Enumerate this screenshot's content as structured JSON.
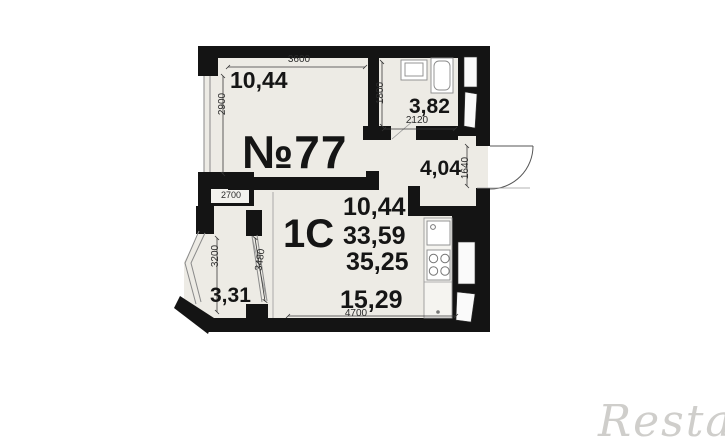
{
  "plan": {
    "apartment_number": "№77",
    "apartment_type": "1C",
    "rooms": {
      "bedroom_area": "10,44",
      "bathroom_area": "3,82",
      "hallway_area": "4,04",
      "living_area": "15,29",
      "balcony_area": "3,31"
    },
    "area_summary": [
      "10,44",
      "33,59",
      "35,25"
    ],
    "dimensions": {
      "bedroom_width": "3600",
      "bedroom_depth": "2900",
      "bathroom_depth": "1800",
      "bathroom_width": "2120",
      "entry_width": "1640",
      "balcony_width": "2700",
      "balcony_depth": "3200",
      "balcony_glazing": "3480",
      "living_width": "4700"
    },
    "colors": {
      "wall": "#141414",
      "floor": "#edebe5",
      "dim_text": "#2b2b2b",
      "watermark": "#cfcecb"
    }
  },
  "watermark": "Restate"
}
